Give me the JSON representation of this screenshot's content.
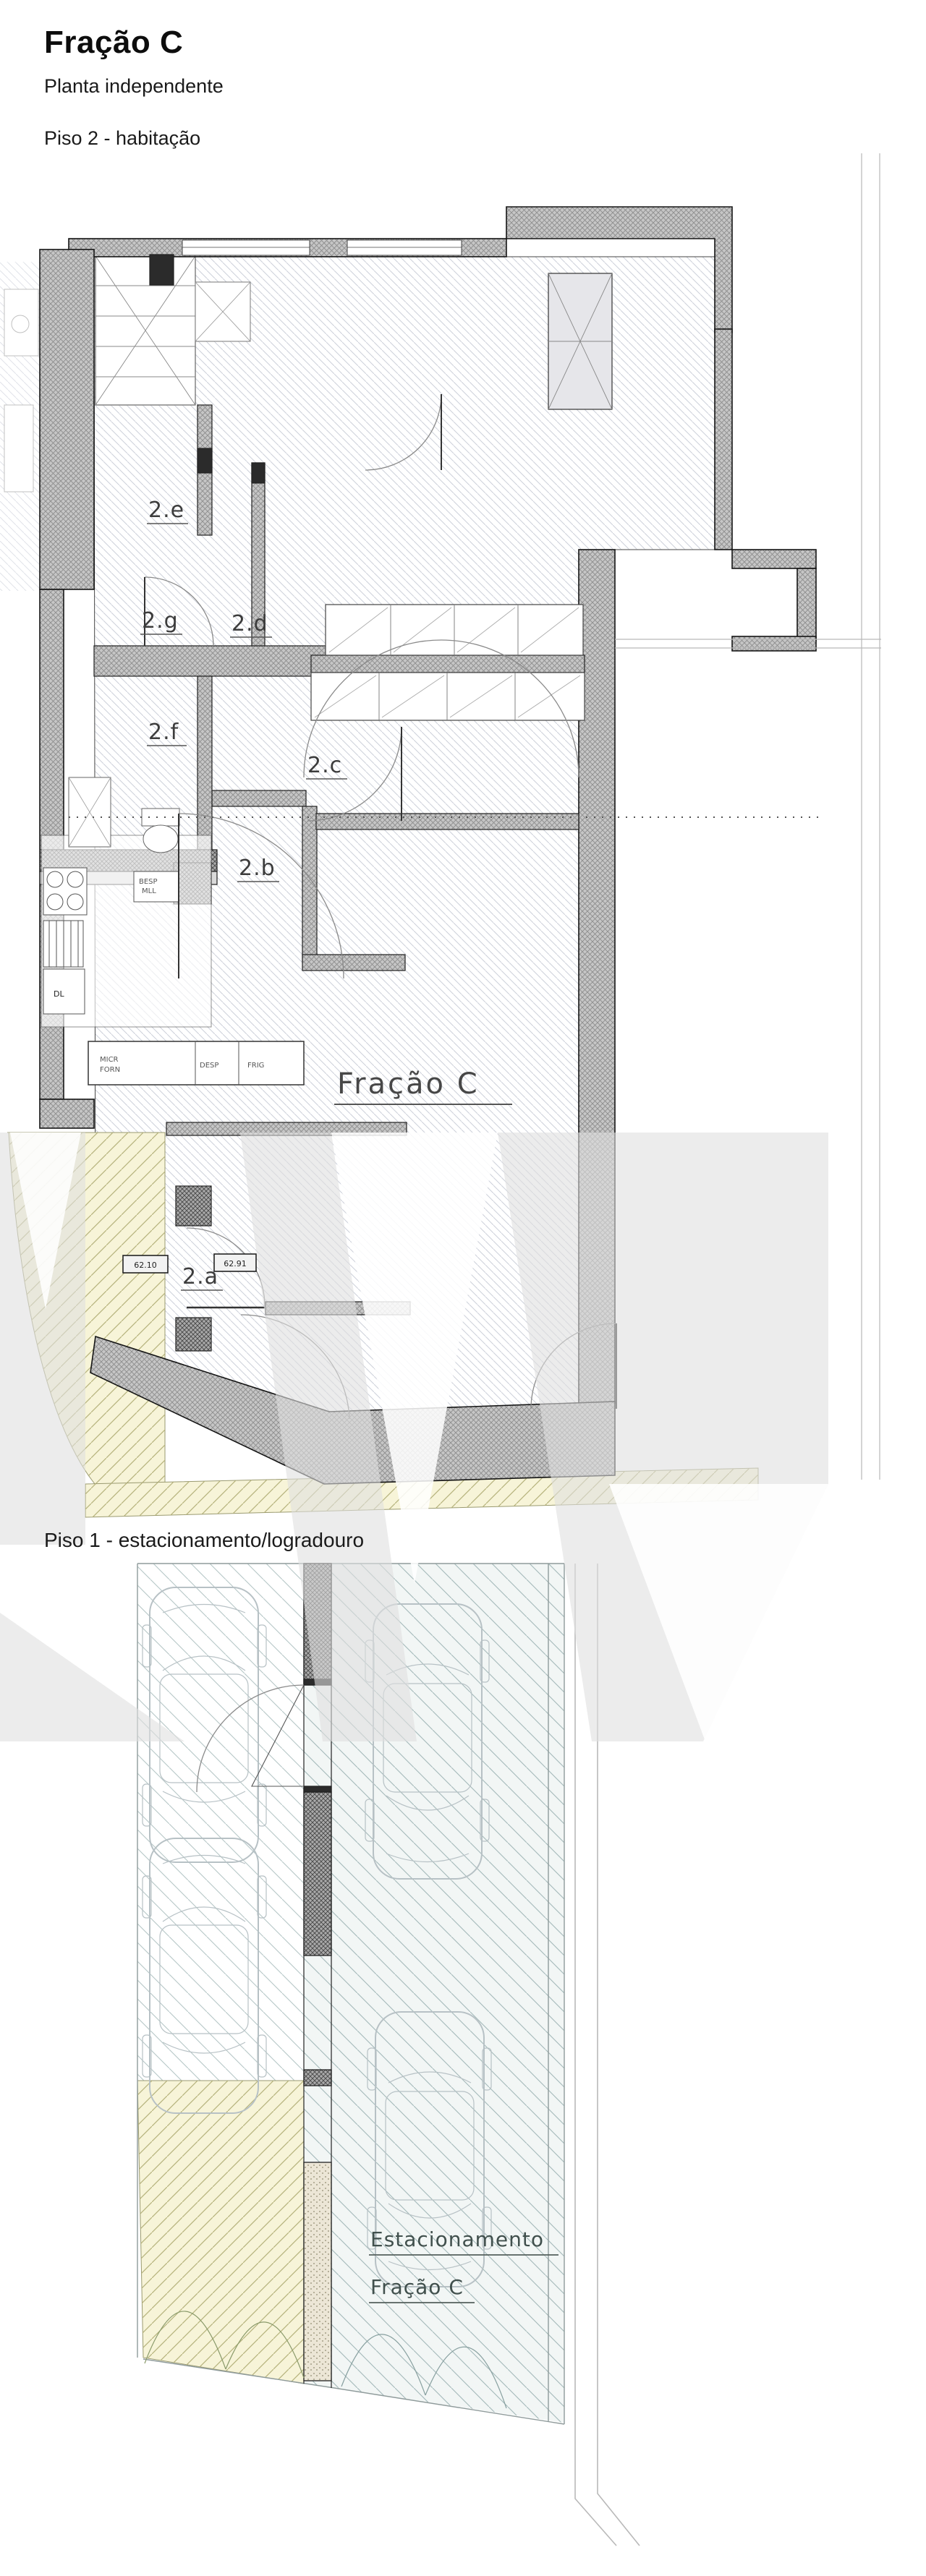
{
  "header": {
    "title": "Fração C",
    "subtitle": "Planta independente",
    "plan2_heading": "Piso 2 - habitação",
    "plan1_heading": "Piso 1 - estacionamento/logradouro"
  },
  "plan2": {
    "unit_label": "Fração C",
    "room_2e": "2.e",
    "room_2g": "2.g",
    "room_2d": "2.d",
    "room_2f": "2.f",
    "room_2c": "2.c",
    "room_2b": "2.b",
    "room_2a": "2.a",
    "level_1": "62.10",
    "level_2": "62.91",
    "kitchen": {
      "c1a": "MICR",
      "c1b": "FORN",
      "c2": "DESP",
      "c3": "FRIG",
      "sink1": "BESP",
      "sink2": "MLL",
      "dl": "DL"
    }
  },
  "plan1": {
    "space_label_line1": "Estacionamento",
    "space_label_line2": "Fração C"
  },
  "colors": {
    "wall_fill": "#c6c6c6",
    "floor_hatch_line": "#ccd0d9",
    "yard_bg": "#f7f4d8",
    "yard_hatch_line": "#b5b27b",
    "parking_bg": "#f2f6f5",
    "parking_hatch_line": "#a3b8b8",
    "watermark_gray": "#dfdfdf",
    "line_dark": "#1a1a1a"
  }
}
